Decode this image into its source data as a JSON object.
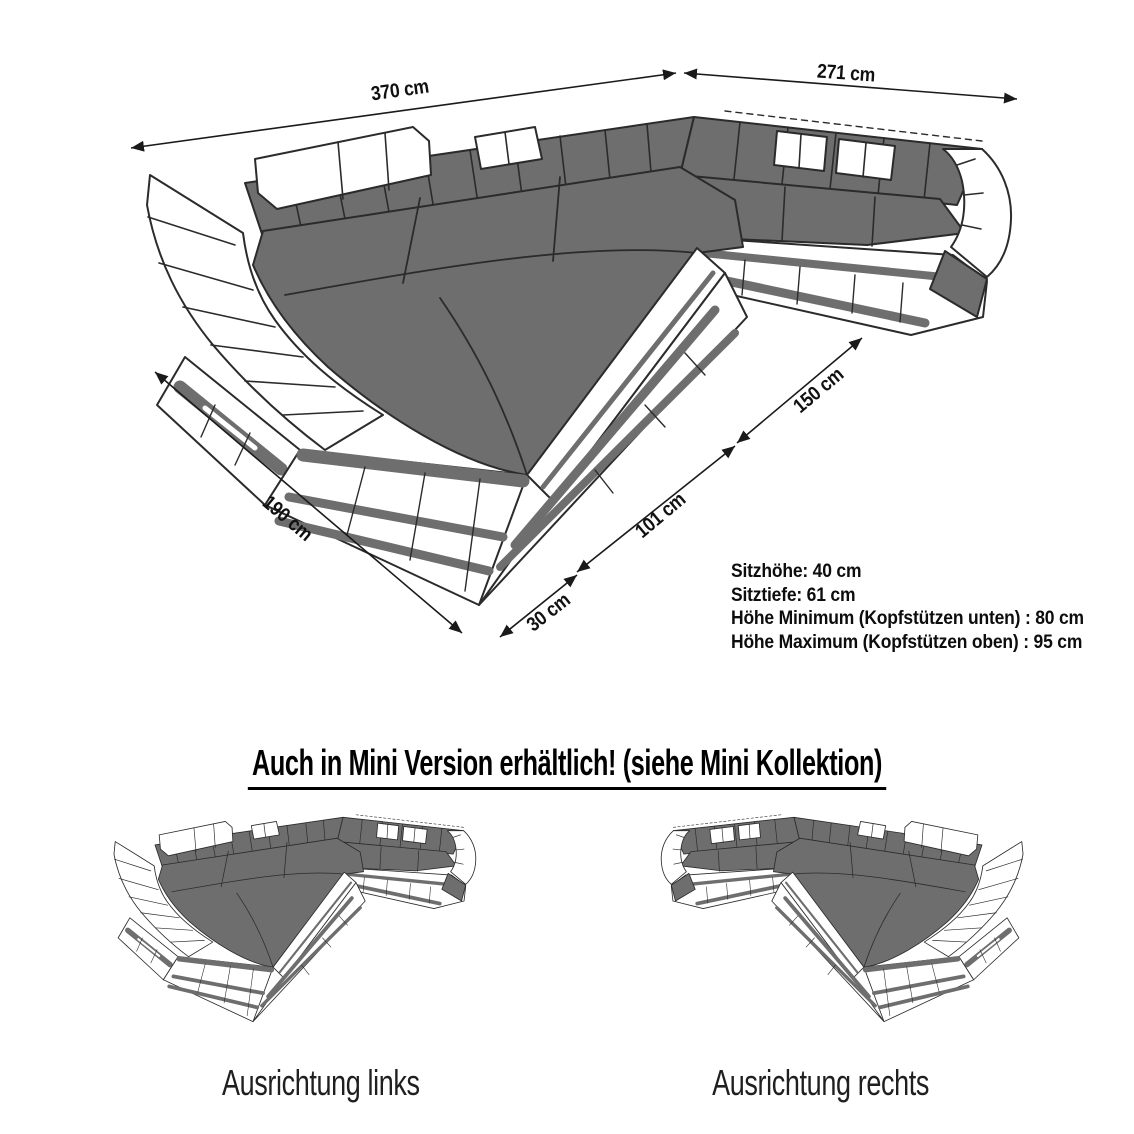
{
  "product_diagram": {
    "dimension_labels": {
      "d370": "370 cm",
      "d271": "271 cm",
      "d150": "150 cm",
      "d101": "101 cm",
      "d190": "190 cm",
      "d30": "30 cm"
    },
    "specs": {
      "line1": "Sitzhöhe: 40 cm",
      "line2": "Sitztiefe: 61 cm",
      "line3": "Höhe Minimum (Kopfstützen unten) : 80 cm",
      "line4": "Höhe Maximum (Kopfstützen oben) : 95 cm"
    },
    "mini_section": {
      "heading": "Auch in Mini Version erhältlich! (siehe Mini Kollektion)",
      "caption_left": "Ausrichtung links",
      "caption_right": "Ausrichtung rechts"
    },
    "colors": {
      "sofa_gray": "#6e6e6e",
      "outline": "#2b2b2b",
      "arrow": "#1a1a1a",
      "text": "#111111"
    }
  }
}
